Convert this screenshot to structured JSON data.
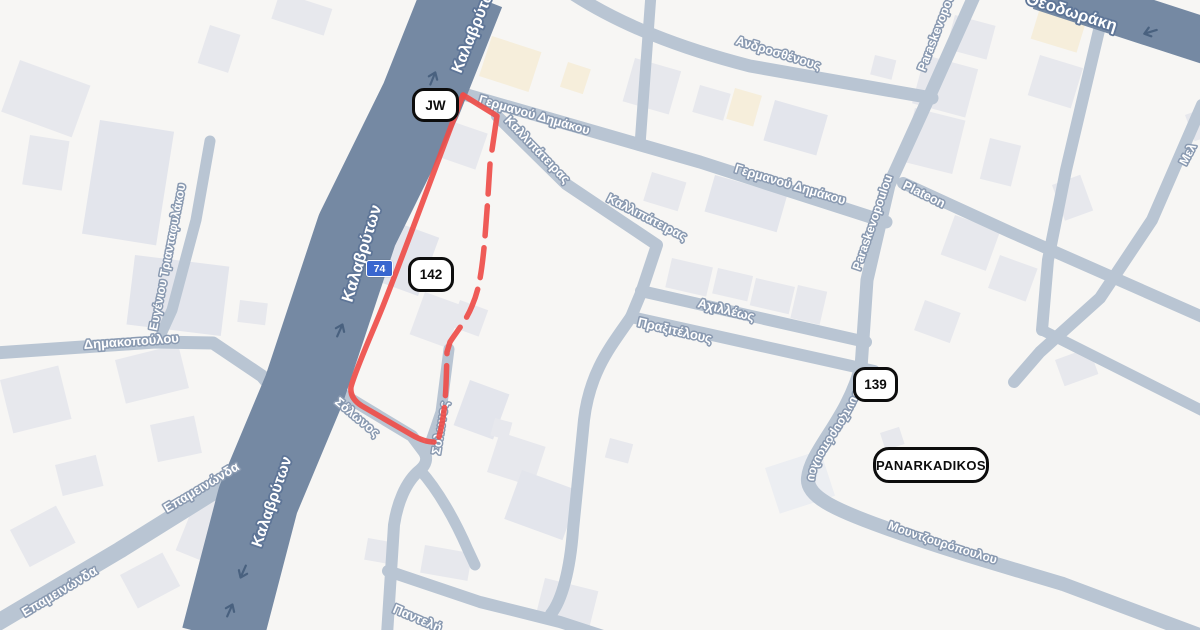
{
  "map": {
    "road_labels": {
      "kalavryton": "Καλαβρύτων",
      "theodoraki": "Θεοδωράκη",
      "germanou_dimakou": "Γερμανού Δημάκου",
      "kallipateiras": "Καλλιπάτειρας",
      "androsthenous": "Ανδροσθένους",
      "paraskevopoulou": "Paraskevopoulou",
      "plateon": "Plateon",
      "achilleos": "Αχιλλέως",
      "praxitelous": "Πραξιτέλους",
      "mel_partial": "Μελ",
      "dimakopoulou": "Δημακοπούλου",
      "evgeniou_triantafylakou": "Ευγένιου Τριανταφυλάκου",
      "epameinonda": "Επαμεινώνδα",
      "solonos": "Σόλωνος",
      "panteli_partial": "Παντελή",
      "mountzouropoulou": "Μουντζουρόπουλου"
    },
    "markers": {
      "jw": "JW",
      "marker_142": "142",
      "marker_139": "139",
      "panarkadikos": "PANARKADIKOS"
    },
    "route_shield": "74",
    "colors": {
      "background": "#f7f6f4",
      "building": "#e7e8ed",
      "building_beige": "#f6eedb",
      "road_major": "#7589a3",
      "road_minor": "#b9c5d3",
      "route": "#ee4d49",
      "shield_bg": "#3966cf",
      "marker_border": "#0d0d0d"
    }
  }
}
